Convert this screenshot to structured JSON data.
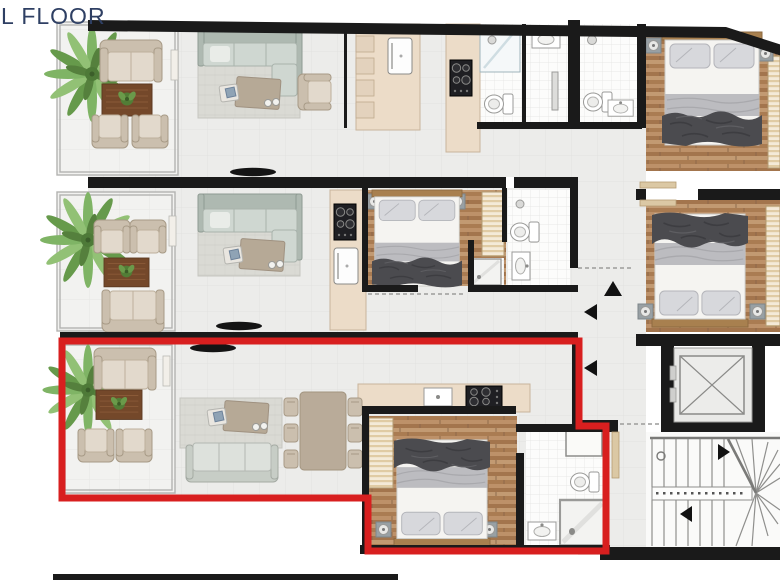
{
  "title": {
    "text": "L FLOOR"
  },
  "colors": {
    "title": "#2e3f63",
    "wall": "#1a1a1a",
    "highlight_outline": "#d81f1f",
    "tile_floor": "#ececea",
    "balcony_floor": "#f2f2f0",
    "bath_tile": "#fcfcfb",
    "wood_floor": "#b28459",
    "kitchen_counter": "#ecdcc8",
    "sofa_tan": "#cbbfae",
    "sofa_gray_green": "#cfd7d1",
    "rug_brown": "#74482a",
    "rug_gray": "#d9d9d3",
    "plant_green": "#7cae5d",
    "bedding_dark": "#4b4b4f",
    "bedding_gray": "#bcbcc0",
    "stair_line": "#8f8f8d"
  },
  "units": [
    {
      "id": "unit-top",
      "highlighted": false,
      "rooms": [
        "balcony",
        "living-room",
        "kitchen",
        "bathroom-1",
        "bathroom-2",
        "bedroom",
        "en-suite-bathroom"
      ]
    },
    {
      "id": "unit-middle",
      "highlighted": false,
      "rooms": [
        "balcony",
        "living-room",
        "kitchen",
        "bedroom",
        "bathroom"
      ]
    },
    {
      "id": "unit-bottom",
      "highlighted": true,
      "rooms": [
        "balcony",
        "living-room",
        "dining-area",
        "kitchen",
        "bedroom",
        "bathroom"
      ]
    }
  ],
  "core": {
    "elements": [
      "hallway",
      "elevator",
      "staircase"
    ]
  },
  "annotations": {
    "hallway_arrows": [
      "up",
      "left",
      "left"
    ],
    "stair_arrows": [
      "right",
      "left"
    ]
  }
}
